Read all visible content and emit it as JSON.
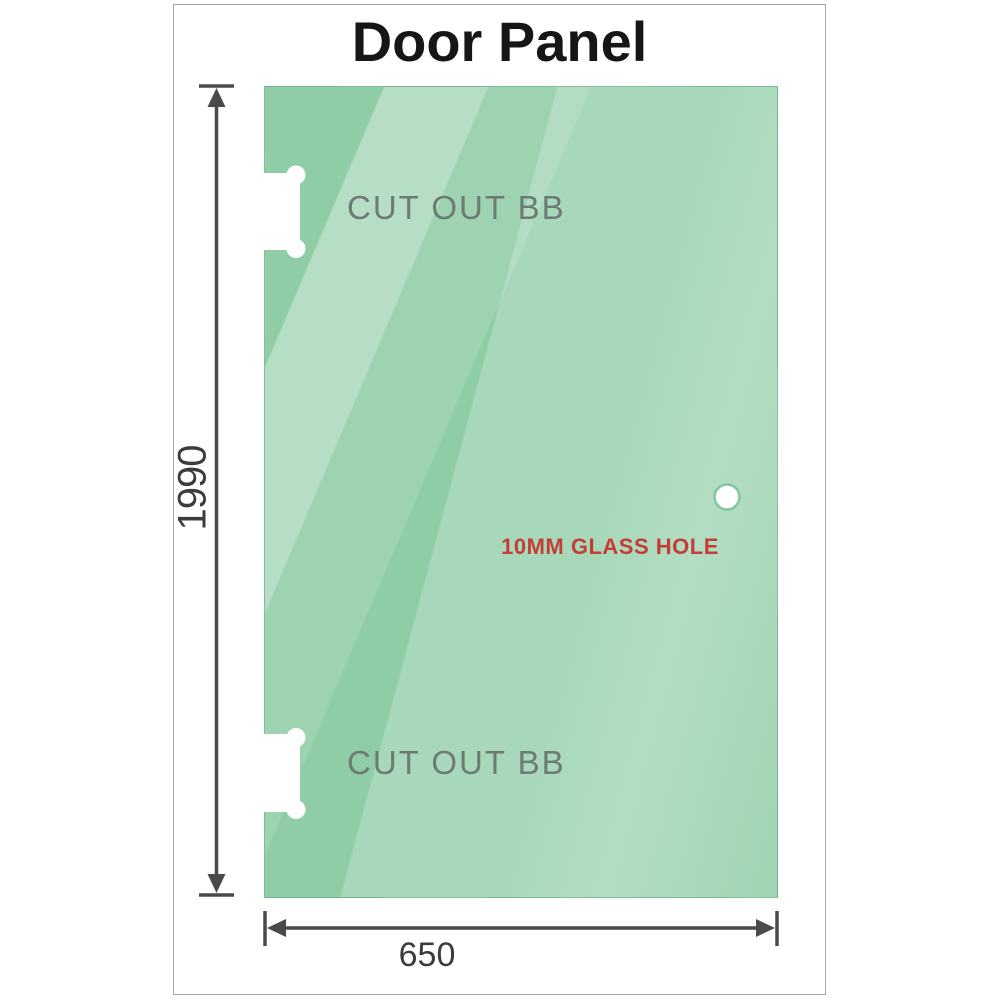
{
  "title": "Door Panel",
  "panel": {
    "cutout_top_label": "CUT OUT BB",
    "cutout_bottom_label": "CUT OUT BB",
    "hole_label": "10MM GLASS HOLE"
  },
  "dimensions": {
    "height_label": "1990",
    "width_label": "650"
  },
  "colors": {
    "glass_base": "#8fcda6",
    "glass_highlight": "#c6e8d2",
    "dimension_line": "#4a4a4a",
    "dimension_text": "#3c3c3c",
    "cutout_label_text": "#6e7a74",
    "hole_label_text": "#c43e38",
    "frame_border": "#a3a8a6",
    "cutout_fill": "#ffffff",
    "hole_ring": "#7fc7a1"
  },
  "icons": {
    "vertical_dimension_arrow": "double-headed vertical arrow with end caps",
    "horizontal_dimension_arrow": "double-headed horizontal arrow with end ticks",
    "hinge_cutout_shape": "white dog-bone hinge cutout",
    "glass_hole_shape": "white circular glass hole"
  }
}
